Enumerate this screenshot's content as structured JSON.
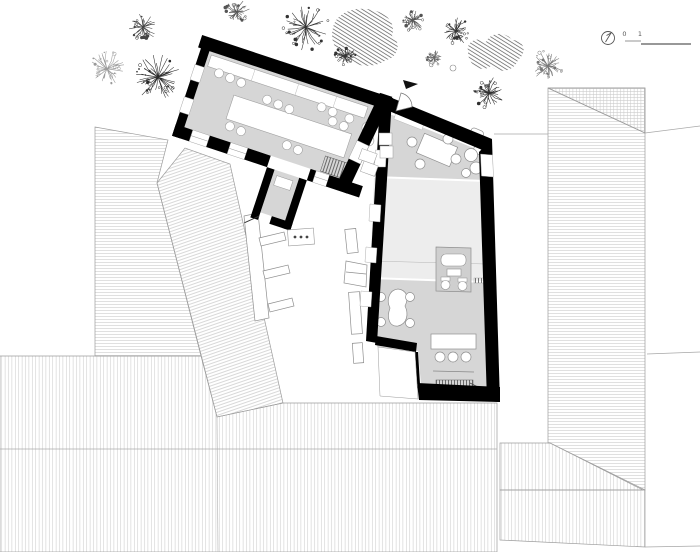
{
  "scale_bar": {
    "labels": [
      "0",
      "1",
      "5"
    ]
  },
  "palette": {
    "wall": "#000000",
    "floor": "#d6d6d6",
    "floor_light": "#ededed",
    "fixture_block": "#cfcfcf",
    "roof_outline": "#9c9c9c",
    "roof_hatch": "#c6c6c6",
    "bush_hatch": "#4a4a4a",
    "furniture_outline": "#8f8f8f"
  },
  "site": {
    "trees": [
      {
        "x": 107,
        "y": 69,
        "r": 17,
        "tone": "#9a9a9a"
      },
      {
        "x": 158,
        "y": 77,
        "r": 22,
        "tone": "#2a2a2a"
      },
      {
        "x": 143,
        "y": 27,
        "r": 14,
        "tone": "#444444"
      },
      {
        "x": 237,
        "y": 12,
        "r": 12,
        "tone": "#555555"
      },
      {
        "x": 306,
        "y": 27,
        "r": 22,
        "tone": "#333333"
      },
      {
        "x": 345,
        "y": 56,
        "r": 10,
        "tone": "#333333"
      },
      {
        "x": 413,
        "y": 20,
        "r": 11,
        "tone": "#555555"
      },
      {
        "x": 456,
        "y": 31,
        "r": 14,
        "tone": "#333333"
      },
      {
        "x": 434,
        "y": 58,
        "r": 8,
        "tone": "#666666"
      },
      {
        "x": 548,
        "y": 66,
        "r": 15,
        "tone": "#777777"
      },
      {
        "x": 489,
        "y": 93,
        "r": 15,
        "tone": "#2f2f2f"
      }
    ]
  }
}
